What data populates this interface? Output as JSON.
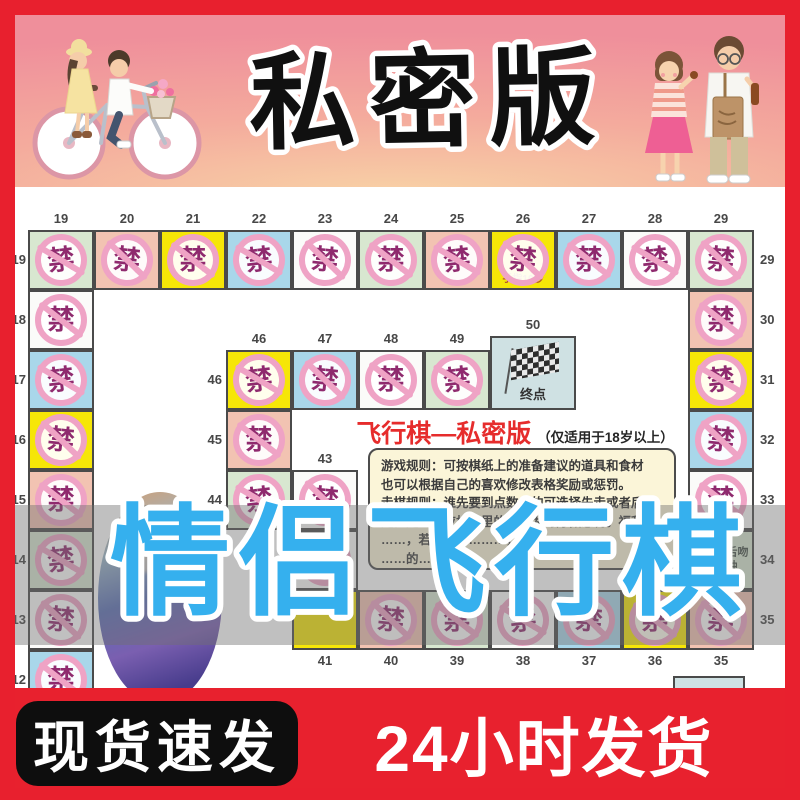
{
  "colors": {
    "frame_red": "#e8202e",
    "banner_gradient_from": "#ef8f9b",
    "banner_gradient_to": "#f8d2a6",
    "title_fill": "#101010",
    "blue_text": "#35b0ee",
    "stamp_ring": "#efa3c5",
    "stamp_char_color": "#8f2a6e",
    "red_title": "#e62c2c",
    "rules_bg": "#fbf5d8",
    "bottom_bg": "#e8212e",
    "pill_bg": "#0e0e0e",
    "cell_palette": {
      "green": "#d8e7d0",
      "salmon": "#f2c3b2",
      "yellow": "#f6e607",
      "blue": "#a9d7ea",
      "white": "#fbfbf9",
      "finish": "#cfe1e3"
    }
  },
  "banner_top": {
    "title": "私密版"
  },
  "overlay": {
    "big_text": "情侣飞行棋"
  },
  "banner_bottom": {
    "left_text": "现货速发",
    "right_text": "24小时发货"
  },
  "board": {
    "red_title": "飞行棋—私密版",
    "age_note": "（仅适用于18岁以上）",
    "stamp_char": "禁",
    "finish_label": "终点",
    "rules_lines": [
      "游戏规则：可按棋纸上的准备建议的道具和食材",
      "也可以根据自己的喜欢修改表格奖励或惩罚。",
      "走棋规则：谁先要到点数大的可选择先走或者后",
      "走。走到对应格子里的内容为对方做惩罚。福利",
      "……，若无法…………，可………",
      "……的……"
    ],
    "cells": [
      {
        "n": 19,
        "x": 28,
        "y": 230,
        "color": "green",
        "labels": [
          "top",
          "leftc"
        ]
      },
      {
        "n": 20,
        "x": 94,
        "y": 230,
        "color": "salmon",
        "labels": [
          "top"
        ]
      },
      {
        "n": 21,
        "x": 160,
        "y": 230,
        "color": "yellow",
        "labels": [
          "top"
        ]
      },
      {
        "n": 22,
        "x": 226,
        "y": 230,
        "color": "blue",
        "labels": [
          "top"
        ]
      },
      {
        "n": 23,
        "x": 292,
        "y": 230,
        "color": "white",
        "labels": [
          "top"
        ]
      },
      {
        "n": 24,
        "x": 358,
        "y": 230,
        "color": "green",
        "labels": [
          "top"
        ]
      },
      {
        "n": 25,
        "x": 424,
        "y": 230,
        "color": "salmon",
        "labels": [
          "top"
        ]
      },
      {
        "n": 26,
        "x": 490,
        "y": 230,
        "color": "yellow",
        "labels": [
          "top"
        ],
        "text": "手指10秒",
        "textPos": "bottom"
      },
      {
        "n": 27,
        "x": 556,
        "y": 230,
        "color": "blue",
        "labels": [
          "top"
        ]
      },
      {
        "n": 28,
        "x": 622,
        "y": 230,
        "color": "white",
        "labels": [
          "top"
        ]
      },
      {
        "n": 29,
        "x": 688,
        "y": 230,
        "color": "green",
        "labels": [
          "top",
          "right"
        ]
      },
      {
        "n": 30,
        "x": 688,
        "y": 290,
        "color": "salmon",
        "labels": [
          "right"
        ]
      },
      {
        "n": 31,
        "x": 688,
        "y": 350,
        "color": "yellow",
        "labels": [
          "right"
        ]
      },
      {
        "n": 32,
        "x": 688,
        "y": 410,
        "color": "blue",
        "labels": [
          "right"
        ]
      },
      {
        "n": 33,
        "x": 688,
        "y": 470,
        "color": "white",
        "labels": [
          "right"
        ]
      },
      {
        "n": 34,
        "x": 688,
        "y": 530,
        "color": "green",
        "labels": [
          "right"
        ],
        "stamp": false,
        "text": "和对方舌吻半分钟",
        "textPos": "center"
      },
      {
        "n": 35,
        "x": 688,
        "y": 590,
        "color": "salmon",
        "labels": [
          "right",
          "bottom"
        ]
      },
      {
        "n": 18,
        "x": 28,
        "y": 290,
        "color": "white",
        "labels": [
          "leftc"
        ]
      },
      {
        "n": 17,
        "x": 28,
        "y": 350,
        "color": "blue",
        "labels": [
          "leftc"
        ]
      },
      {
        "n": 16,
        "x": 28,
        "y": 410,
        "color": "yellow",
        "labels": [
          "leftc"
        ]
      },
      {
        "n": 15,
        "x": 28,
        "y": 470,
        "color": "salmon",
        "labels": [
          "leftc"
        ]
      },
      {
        "n": 14,
        "x": 28,
        "y": 530,
        "color": "green",
        "labels": [
          "leftc"
        ]
      },
      {
        "n": 13,
        "x": 28,
        "y": 590,
        "color": "white",
        "labels": [
          "leftc"
        ]
      },
      {
        "n": 12,
        "x": 28,
        "y": 650,
        "color": "blue",
        "labels": [
          "leftc"
        ]
      },
      {
        "n": 46,
        "x": 226,
        "y": 350,
        "color": "yellow",
        "labels": [
          "top",
          "lefti"
        ]
      },
      {
        "n": 47,
        "x": 292,
        "y": 350,
        "color": "blue",
        "labels": [
          "top"
        ]
      },
      {
        "n": 48,
        "x": 358,
        "y": 350,
        "color": "white",
        "labels": [
          "top"
        ]
      },
      {
        "n": 49,
        "x": 424,
        "y": 350,
        "color": "green",
        "labels": [
          "top"
        ]
      },
      {
        "n": 50,
        "x": 490,
        "y": 336,
        "w": 86,
        "h": 74,
        "color": "finish",
        "labels": [
          "top"
        ],
        "stamp": false,
        "flag": true
      },
      {
        "n": 45,
        "x": 226,
        "y": 410,
        "color": "salmon",
        "labels": [
          "lefti"
        ]
      },
      {
        "n": 44,
        "x": 226,
        "y": 470,
        "color": "green",
        "labels": [
          "lefti"
        ]
      },
      {
        "n": 43,
        "x": 292,
        "y": 470,
        "color": "white",
        "labels": [
          "top"
        ]
      },
      {
        "n": 42,
        "x": 292,
        "y": 530,
        "color": "white",
        "labels": []
      },
      {
        "n": 41,
        "x": 292,
        "y": 590,
        "color": "yellow",
        "labels": [
          "bottom"
        ],
        "stamp": false
      },
      {
        "n": 40,
        "x": 358,
        "y": 590,
        "color": "salmon",
        "labels": [
          "bottom"
        ]
      },
      {
        "n": 39,
        "x": 424,
        "y": 590,
        "color": "green",
        "labels": [
          "bottom"
        ]
      },
      {
        "n": 38,
        "x": 490,
        "y": 590,
        "color": "white",
        "labels": [
          "bottom"
        ]
      },
      {
        "n": 37,
        "x": 556,
        "y": 590,
        "color": "blue",
        "labels": [
          "bottom"
        ]
      },
      {
        "n": 36,
        "x": 622,
        "y": 590,
        "color": "yellow",
        "labels": [
          "bottom"
        ]
      }
    ]
  }
}
